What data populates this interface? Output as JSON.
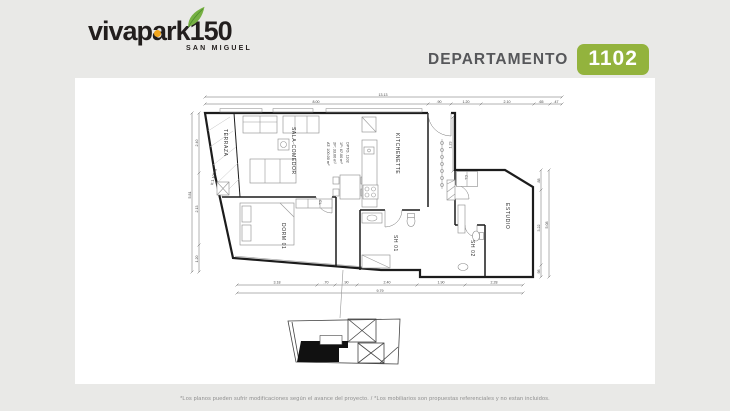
{
  "logo": {
    "brand": "vivapark",
    "number": "150",
    "subtitle": "SAN MIGUEL",
    "leaf_color": "#76b043",
    "dot_color": "#f2a61d"
  },
  "header": {
    "title": "DEPARTAMENTO",
    "unit": "1102",
    "badge_color": "#93b33d",
    "title_color": "#56575a"
  },
  "plan": {
    "unit_info": {
      "line1": "DPTO. 1102",
      "line2": "1P: 67.00 m²",
      "line3": "2P: 33.00 m²",
      "line4": "AT: 100.00 m²"
    },
    "rooms": {
      "terraza": "TERRAZA",
      "sala": "SALA-COMEDOR",
      "kitchenette": "KITCHENETTE",
      "dorm": "DORM 01",
      "estudio": "ESTUDIO",
      "sh1": "SH 01",
      "sh2": "SH 02",
      "cl1": "CL",
      "cl2": "CL"
    },
    "annotations": {
      "height_note": "h:1.10(m)"
    },
    "dims": {
      "top_total": "13.13",
      "top_segments": [
        "8.00",
        ".90",
        "1.20",
        "2.10",
        ".65",
        ".47"
      ],
      "bottom_segments": [
        "3.18",
        ".70",
        ".90",
        "2.40",
        "1.90",
        "2.28"
      ],
      "bottom_total": "9.79",
      "left_total": "5.81",
      "left_segments": [
        "2.40",
        "2.13",
        "1.20"
      ],
      "right_total": "5.08",
      "right_segments": [
        ".88",
        "3.22",
        ".98"
      ],
      "hall": "1.23"
    }
  },
  "footer": {
    "disclaimer": "*Los planos pueden sufrir modificaciones según el avance del proyecto. / *Los mobiliarios son propuestas referenciales y no estan incluidos."
  }
}
